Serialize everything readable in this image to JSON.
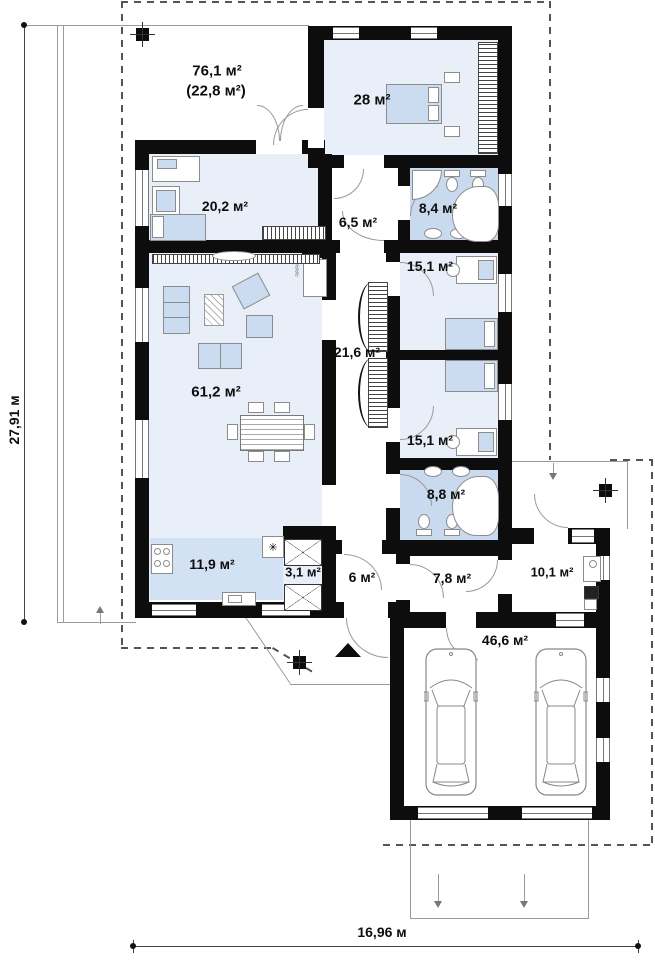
{
  "plan": {
    "title": "Single-storey house floor plan",
    "rooms": [
      {
        "id": "terrace",
        "area": "76,1 м²",
        "area_note": "(22,8 м²)"
      },
      {
        "id": "bedroom-main",
        "area": "28 м²"
      },
      {
        "id": "study",
        "area": "20,2 м²"
      },
      {
        "id": "corridor",
        "area": "6,5 м²"
      },
      {
        "id": "bathroom-1",
        "area": "8,4 м²"
      },
      {
        "id": "bedroom-2",
        "area": "15,1 м²"
      },
      {
        "id": "hallway",
        "area": "21,6 м²"
      },
      {
        "id": "living-room",
        "area": "61,2 м²"
      },
      {
        "id": "bedroom-3",
        "area": "15,1 м²"
      },
      {
        "id": "bathroom-2",
        "area": "8,8 м²"
      },
      {
        "id": "kitchen",
        "area": "11,9 м²"
      },
      {
        "id": "pantry",
        "area": "3,1 м²"
      },
      {
        "id": "entry",
        "area": "6 м²"
      },
      {
        "id": "hall",
        "area": "7,8 м²"
      },
      {
        "id": "utility",
        "area": "10,1 м²"
      },
      {
        "id": "garage",
        "area": "46,6 м²"
      }
    ],
    "dimensions": {
      "left": "27,91 м",
      "bottom": "16,96 м"
    },
    "markers": {
      "boiler_symbol": "✳"
    },
    "colors": {
      "wall": "#0d0d0d",
      "room": "#e9eff8",
      "wet_room": "#c9daef",
      "kitchen_zone": "#d2e1f3",
      "furniture": "#ccdcf0",
      "outline": "#8c8c8c"
    }
  }
}
